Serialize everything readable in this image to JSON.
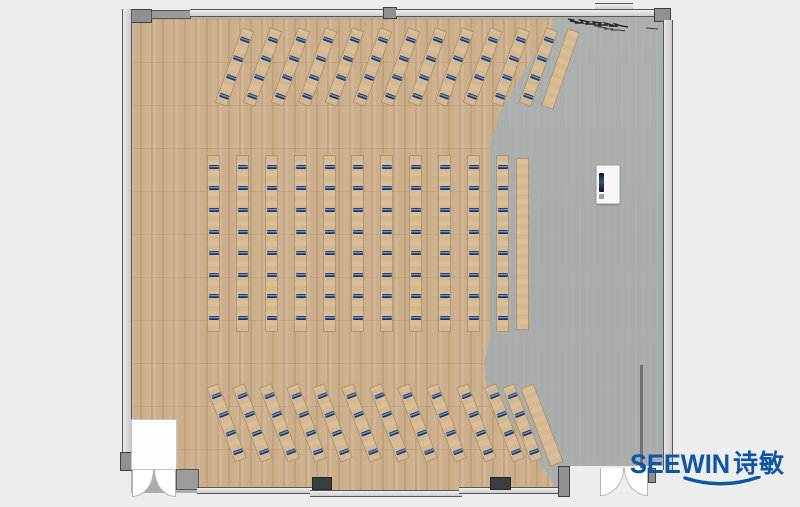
{
  "meta": {
    "description": "Top-down rendered office/classroom floor plan with rows of angled training desks, a central block of desk columns, wood and concrete flooring, and a SEEWIN brand watermark",
    "visible_text_items": [
      "SEEWIN",
      "诗敏"
    ]
  },
  "palette": {
    "page_bg": "#ededed",
    "wood_floor": "#cbae8a",
    "gray_floor": "#a9adac",
    "desk": "#d9bc95",
    "workstation_marker": "#14305f",
    "wall_gray": "#9b9b9b",
    "pillar_dark": "#3a3d3f",
    "logo_blue": "#0d55a6"
  },
  "workstations_summary": {
    "top_angled_desks": 12,
    "middle_desk_columns": 11,
    "bottom_angled_desks": 12,
    "seats_per_angled_desk": 4,
    "seats_per_column": 8,
    "side_tables_without_seats": 3
  },
  "furniture": {
    "desk_width": 13,
    "rows": [
      {
        "name": "top-angled-desk-row",
        "angle": 20,
        "top": 27,
        "desk_h": 80,
        "desk_w": 13,
        "markers_per_desk": 4,
        "marker_start": 0.1,
        "marker_step": 0.25,
        "desk_x": [
          228,
          256,
          284,
          311,
          338,
          366,
          394,
          421,
          448,
          476,
          504,
          532
        ],
        "plain": {
          "x": 554,
          "y": 28,
          "w": 13,
          "h": 82,
          "angle": 19
        }
      },
      {
        "name": "middle-desk-columns",
        "angle": 0,
        "top": 155,
        "desk_h": 177,
        "desk_w": 13,
        "markers_per_desk": 8,
        "marker_start": 0.05,
        "marker_step": 0.122,
        "desk_x": [
          207,
          236,
          265,
          294,
          323,
          351,
          380,
          409,
          438,
          467,
          496
        ],
        "plain": {
          "x": 516,
          "y": 158,
          "w": 13,
          "h": 172,
          "angle": 0
        }
      },
      {
        "name": "bottom-angled-desk-row",
        "angle": -21,
        "top": 383,
        "desk_h": 80,
        "desk_w": 13,
        "markers_per_desk": 4,
        "marker_start": 0.1,
        "marker_step": 0.25,
        "desk_x": [
          220,
          246,
          273,
          300,
          326,
          355,
          383,
          411,
          440,
          470,
          498,
          516
        ],
        "plain": {
          "x": 535,
          "y": 383,
          "w": 14,
          "h": 84,
          "angle": -21
        }
      }
    ]
  },
  "room": {
    "structures": [
      {
        "name": "corner-post-top-left",
        "x": 131,
        "y": 9,
        "w": 21,
        "h": 14,
        "style": "block"
      },
      {
        "name": "left-glass-wall",
        "x": 122,
        "y": 9,
        "w": 10,
        "h": 450,
        "style": "window-v"
      },
      {
        "name": "top-wall-left-segment",
        "x": 151,
        "y": 10,
        "w": 40,
        "h": 9,
        "style": "solid"
      },
      {
        "name": "top-window-left",
        "x": 190,
        "y": 9,
        "w": 194,
        "h": 8,
        "style": "window-h"
      },
      {
        "name": "top-wall-mullion",
        "x": 383,
        "y": 7,
        "w": 14,
        "h": 12,
        "style": "block"
      },
      {
        "name": "top-window-right",
        "x": 396,
        "y": 9,
        "w": 200,
        "h": 8,
        "style": "window-h"
      },
      {
        "name": "top-window-outer-tab",
        "x": 595,
        "y": 3,
        "w": 38,
        "h": 7,
        "style": "window-h"
      },
      {
        "name": "top-window-right-end",
        "x": 596,
        "y": 9,
        "w": 59,
        "h": 8,
        "style": "window-h"
      },
      {
        "name": "corner-post-top-right",
        "x": 654,
        "y": 8,
        "w": 17,
        "h": 14,
        "style": "block"
      },
      {
        "name": "right-glass-wall",
        "x": 663,
        "y": 20,
        "w": 10,
        "h": 450,
        "style": "window-v"
      },
      {
        "name": "right-partition-line",
        "x": 640,
        "y": 365,
        "w": 3,
        "h": 103,
        "style": "line"
      },
      {
        "name": "left-wall-end-post",
        "x": 120,
        "y": 452,
        "w": 14,
        "h": 19,
        "style": "block"
      },
      {
        "name": "vestibule-recess",
        "x": 131,
        "y": 419,
        "w": 46,
        "h": 51,
        "style": "white"
      },
      {
        "name": "entry-door-left-leaf",
        "x": 132,
        "y": 470,
        "w": 22,
        "h": 27,
        "style": "fan-left"
      },
      {
        "name": "entry-door-right-leaf",
        "x": 154,
        "y": 470,
        "w": 22,
        "h": 27,
        "style": "fan-right"
      },
      {
        "name": "wall-corner-piece",
        "x": 176,
        "y": 469,
        "w": 23,
        "h": 21,
        "style": "solid"
      },
      {
        "name": "bottom-window-segment-a",
        "x": 197,
        "y": 487,
        "w": 116,
        "h": 7,
        "style": "window-h"
      },
      {
        "name": "bottom-window-segment-b",
        "x": 310,
        "y": 490,
        "w": 152,
        "h": 7,
        "style": "window-h"
      },
      {
        "name": "bottom-window-segment-c",
        "x": 459,
        "y": 487,
        "w": 101,
        "h": 7,
        "style": "window-h"
      },
      {
        "name": "structural-pillar-a",
        "x": 312,
        "y": 477,
        "w": 20,
        "h": 13,
        "style": "dark"
      },
      {
        "name": "structural-pillar-b",
        "x": 490,
        "y": 477,
        "w": 21,
        "h": 13,
        "style": "dark"
      },
      {
        "name": "right-door-post",
        "x": 558,
        "y": 466,
        "w": 12,
        "h": 31,
        "style": "block"
      },
      {
        "name": "exit-door-left-leaf",
        "x": 600,
        "y": 468,
        "w": 24,
        "h": 28,
        "style": "fan-left"
      },
      {
        "name": "exit-door-right-leaf",
        "x": 624,
        "y": 468,
        "w": 24,
        "h": 28,
        "style": "fan-right"
      },
      {
        "name": "exit-door-end-post",
        "x": 648,
        "y": 468,
        "w": 8,
        "h": 15,
        "style": "block"
      }
    ]
  },
  "objects": {
    "podium": {
      "description": "white presenter podium with display",
      "x": 596,
      "y": 165
    },
    "annotation_scribble": {
      "present": true,
      "location": "top-right near wall"
    }
  },
  "logo": {
    "brand": "SEEWIN",
    "cjk": "诗敏",
    "color": "#0d55a6"
  }
}
